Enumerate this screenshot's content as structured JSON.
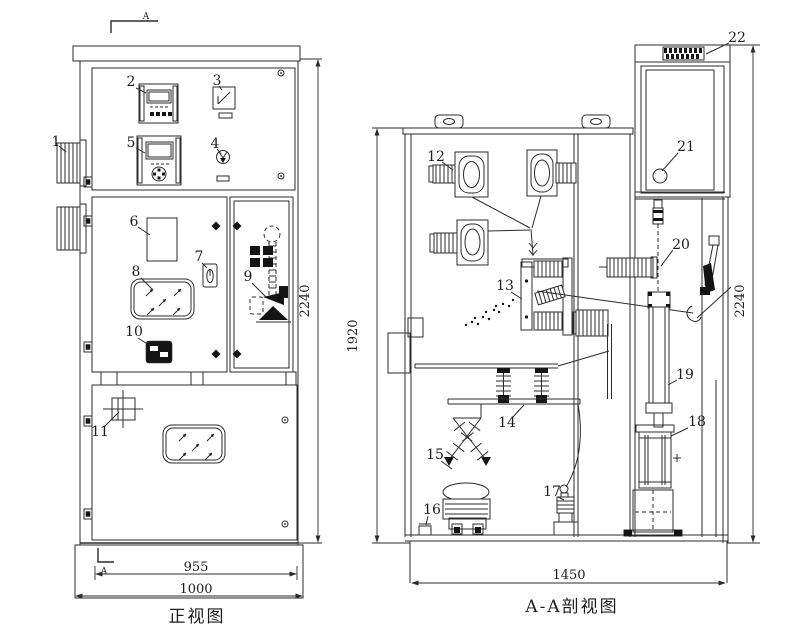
{
  "front_view": {
    "caption": "正视图",
    "section_marker": "A",
    "dimensions": {
      "height": "2240",
      "door_width": "955",
      "overall_width": "1000"
    },
    "part_labels": [
      "1",
      "2",
      "3",
      "4",
      "5",
      "6",
      "7",
      "8",
      "9",
      "10",
      "11"
    ]
  },
  "section_view": {
    "caption": "A-A剖视图",
    "dimensions": {
      "inner_height": "1920",
      "overall_height": "2240",
      "overall_width": "1450"
    },
    "part_labels": [
      "12",
      "13",
      "14",
      "15",
      "16",
      "17",
      "18",
      "19",
      "20",
      "21",
      "22"
    ]
  },
  "style": {
    "line_color": "#2b2b2b",
    "fill_color": "#141414",
    "background": "#ffffff"
  }
}
